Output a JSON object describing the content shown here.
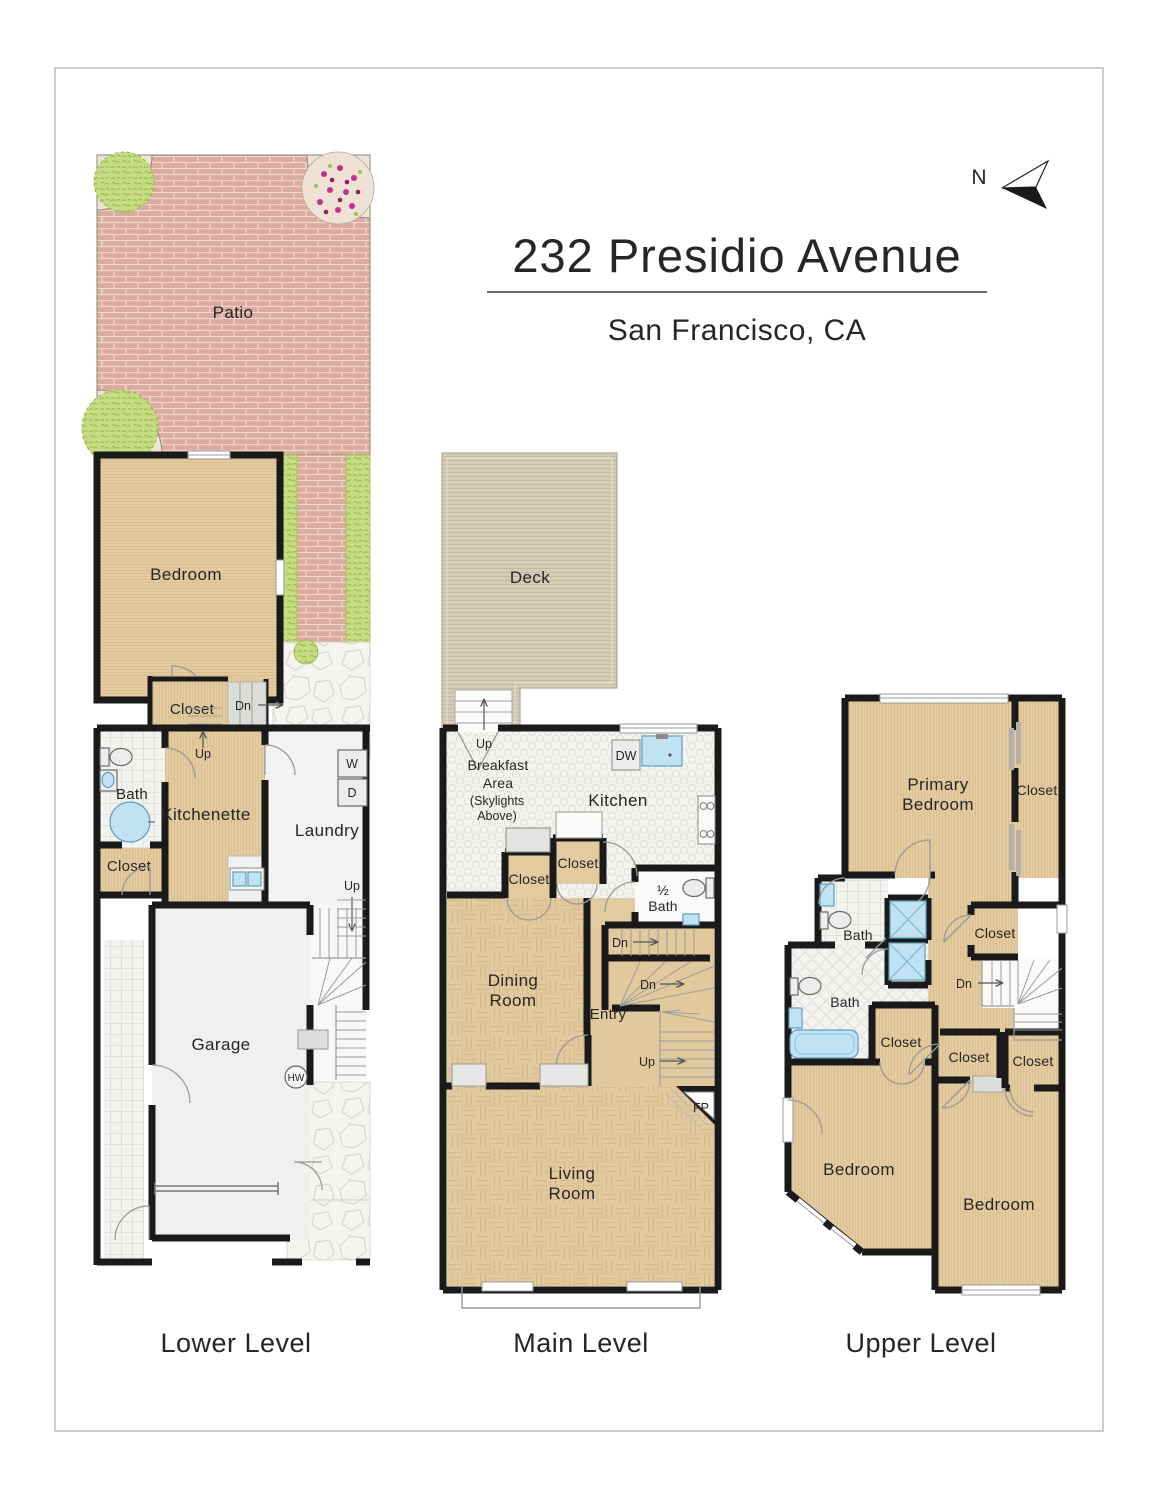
{
  "header": {
    "title": "232 Presidio Avenue",
    "subtitle": "San Francisco, CA",
    "compass": "N"
  },
  "palette": {
    "wall": "#1a1a1a",
    "wood": "#e2c99d",
    "brick": "#dcab9f",
    "deck": "#d5ccb6",
    "water": "#bfe3f3",
    "greenery": "#c0d87e",
    "flower": "#c2308f"
  },
  "levels": {
    "lower": {
      "label": "Lower Level",
      "rooms": {
        "patio": "Patio",
        "bedroom": "Bedroom",
        "closet_hall": "Closet",
        "bath": "Bath",
        "kitchenette": "Kitchenette",
        "laundry": "Laundry",
        "closet_bath": "Closet",
        "garage": "Garage"
      },
      "labels": {
        "dn": "Dn",
        "up_closet": "Up",
        "up_laundry": "Up",
        "washer": "W",
        "dryer": "D",
        "water_heater": "HW"
      }
    },
    "main": {
      "label": "Main Level",
      "rooms": {
        "deck": "Deck",
        "breakfast_line1": "Breakfast",
        "breakfast_line2": "Area",
        "skylights_line1": "(Skylights",
        "skylights_line2": "Above)",
        "kitchen": "Kitchen",
        "closet_left": "Closet",
        "closet_right": "Closet",
        "half_bath_fraction": "½",
        "half_bath": "Bath",
        "dining_line1": "Dining",
        "dining_line2": "Room",
        "entry": "Entry",
        "living_line1": "Living",
        "living_line2": "Room"
      },
      "labels": {
        "up_deck": "Up",
        "dishwasher": "DW",
        "dn_kitchen": "Dn",
        "dn_entry": "Dn",
        "up_entry": "Up",
        "fireplace": "FP"
      }
    },
    "upper": {
      "label": "Upper Level",
      "rooms": {
        "primary_line1": "Primary",
        "primary_line2": "Bedroom",
        "closet_primary": "Closet",
        "bath_top": "Bath",
        "closet_hall_top": "Closet",
        "bath_mid": "Bath",
        "closet_bedroom_left": "Closet",
        "closet_hall_bottom": "Closet",
        "closet_bedroom_right": "Closet",
        "bedroom_left": "Bedroom",
        "bedroom_right": "Bedroom"
      },
      "labels": {
        "dn": "Dn"
      }
    }
  }
}
